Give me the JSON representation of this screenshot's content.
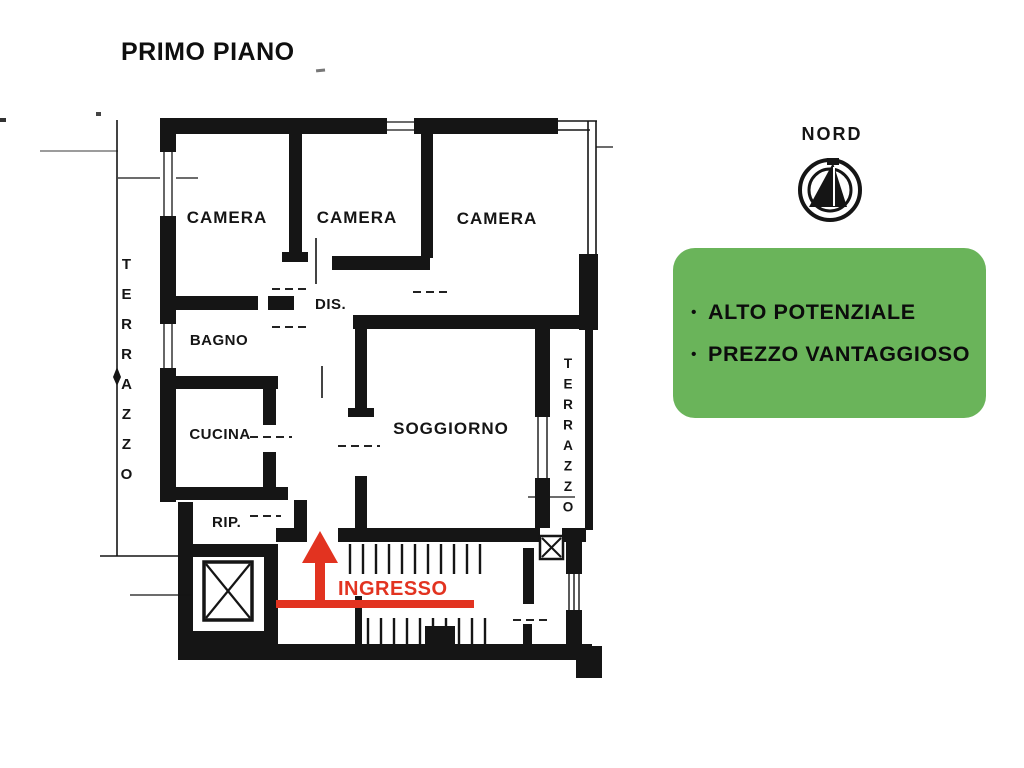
{
  "title": "PRIMO PIANO",
  "compass": {
    "label": "NORD"
  },
  "highlight_card": {
    "bullet": "•",
    "items": [
      {
        "label": "ALTO POTENZIALE"
      },
      {
        "label": "PREZZO VANTAGGIOSO"
      }
    ]
  },
  "colors": {
    "accent": "#e23320",
    "green": "#6ab45a",
    "ink": "#151515"
  },
  "plan": {
    "rooms": {
      "camera1": "CAMERA",
      "camera2": "CAMERA",
      "camera3": "CAMERA",
      "disimpegno": "DIS.",
      "bagno": "BAGNO",
      "cucina": "CUCINA",
      "soggiorno": "SOGGIORNO",
      "ripostiglio": "RIP.",
      "terrazzo_left": "TERRAZZO",
      "terrazzo_right": "TERRAZZO"
    },
    "entrance_label": "INGRESSO"
  }
}
